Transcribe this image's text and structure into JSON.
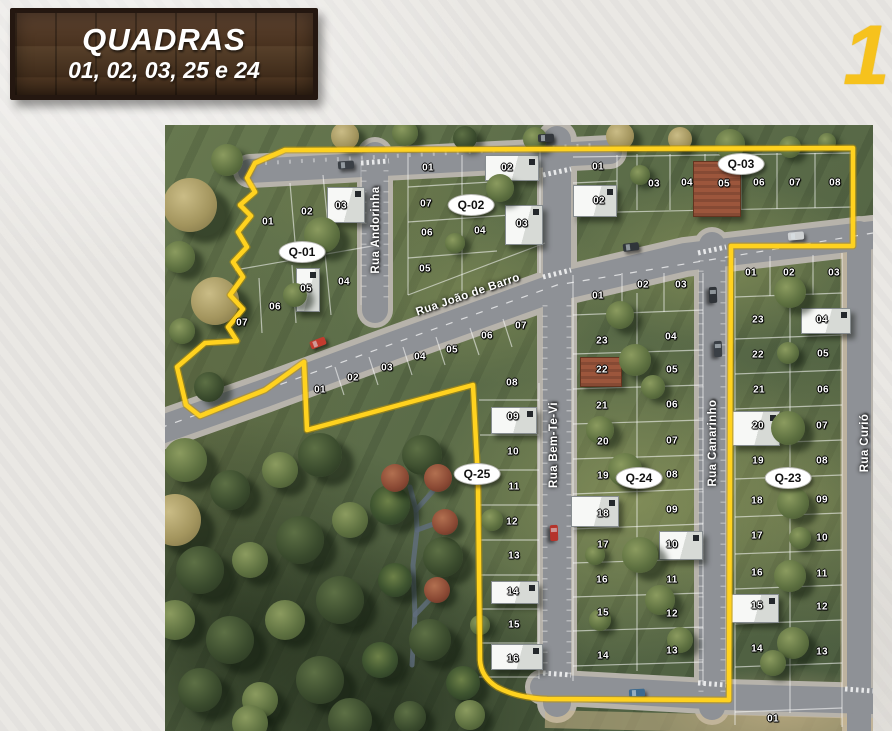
{
  "sign": {
    "title": "QUADRAS",
    "subtitle": "01, 02, 03, 25 e 24"
  },
  "corner_digit": "1",
  "colors": {
    "boundary_yellow": "#ffd21f",
    "sign_wood": "#4a3424",
    "badge_bg": "#ffffff",
    "corner_yellow": "#f6c21d"
  },
  "map": {
    "streets": [
      {
        "name": "Rua Andorinha",
        "x": 211,
        "y": 105,
        "rot": -90
      },
      {
        "name": "Rua João de Barro",
        "x": 303,
        "y": 170,
        "rot": -19
      },
      {
        "name": "Rua Bem-Te-Vi",
        "x": 389,
        "y": 320,
        "rot": -90
      },
      {
        "name": "Rua Canarinho",
        "x": 548,
        "y": 318,
        "rot": -90
      },
      {
        "name": "Rua Curió",
        "x": 700,
        "y": 318,
        "rot": -90
      }
    ],
    "quadra_badges": [
      {
        "id": "Q-01",
        "x": 137,
        "y": 127
      },
      {
        "id": "Q-02",
        "x": 306,
        "y": 80
      },
      {
        "id": "Q-03",
        "x": 576,
        "y": 39
      },
      {
        "id": "Q-25",
        "x": 312,
        "y": 349
      },
      {
        "id": "Q-24",
        "x": 474,
        "y": 353
      },
      {
        "id": "Q-23",
        "x": 623,
        "y": 353
      }
    ],
    "lots": [
      {
        "q": "Q-01",
        "n": "01",
        "x": 103,
        "y": 97
      },
      {
        "q": "Q-01",
        "n": "02",
        "x": 142,
        "y": 87
      },
      {
        "q": "Q-01",
        "n": "03",
        "x": 176,
        "y": 81
      },
      {
        "q": "Q-01",
        "n": "04",
        "x": 179,
        "y": 157
      },
      {
        "q": "Q-01",
        "n": "05",
        "x": 141,
        "y": 164
      },
      {
        "q": "Q-01",
        "n": "06",
        "x": 110,
        "y": 182
      },
      {
        "q": "Q-01",
        "n": "07",
        "x": 77,
        "y": 198
      },
      {
        "q": "Q-02",
        "n": "01",
        "x": 263,
        "y": 43
      },
      {
        "q": "Q-02",
        "n": "02",
        "x": 342,
        "y": 43
      },
      {
        "q": "Q-02",
        "n": "03",
        "x": 357,
        "y": 99
      },
      {
        "q": "Q-02",
        "n": "04",
        "x": 315,
        "y": 106
      },
      {
        "q": "Q-02",
        "n": "05",
        "x": 260,
        "y": 144
      },
      {
        "q": "Q-02",
        "n": "06",
        "x": 262,
        "y": 108
      },
      {
        "q": "Q-02",
        "n": "07",
        "x": 261,
        "y": 79
      },
      {
        "q": "Q-03",
        "n": "01",
        "x": 433,
        "y": 42
      },
      {
        "q": "Q-03",
        "n": "02",
        "x": 434,
        "y": 76
      },
      {
        "q": "Q-03",
        "n": "03",
        "x": 489,
        "y": 59
      },
      {
        "q": "Q-03",
        "n": "04",
        "x": 522,
        "y": 58
      },
      {
        "q": "Q-03",
        "n": "05",
        "x": 559,
        "y": 59
      },
      {
        "q": "Q-03",
        "n": "06",
        "x": 594,
        "y": 58
      },
      {
        "q": "Q-03",
        "n": "07",
        "x": 630,
        "y": 58
      },
      {
        "q": "Q-03",
        "n": "08",
        "x": 670,
        "y": 58
      },
      {
        "q": "Q-25",
        "n": "01",
        "x": 155,
        "y": 265
      },
      {
        "q": "Q-25",
        "n": "02",
        "x": 188,
        "y": 253
      },
      {
        "q": "Q-25",
        "n": "03",
        "x": 222,
        "y": 243
      },
      {
        "q": "Q-25",
        "n": "04",
        "x": 255,
        "y": 232
      },
      {
        "q": "Q-25",
        "n": "05",
        "x": 287,
        "y": 225
      },
      {
        "q": "Q-25",
        "n": "06",
        "x": 322,
        "y": 211
      },
      {
        "q": "Q-25",
        "n": "07",
        "x": 356,
        "y": 201
      },
      {
        "q": "Q-25",
        "n": "08",
        "x": 347,
        "y": 258
      },
      {
        "q": "Q-25",
        "n": "09",
        "x": 348,
        "y": 292
      },
      {
        "q": "Q-25",
        "n": "10",
        "x": 348,
        "y": 327
      },
      {
        "q": "Q-25",
        "n": "11",
        "x": 349,
        "y": 362
      },
      {
        "q": "Q-25",
        "n": "12",
        "x": 347,
        "y": 397
      },
      {
        "q": "Q-25",
        "n": "13",
        "x": 349,
        "y": 431
      },
      {
        "q": "Q-25",
        "n": "14",
        "x": 348,
        "y": 467
      },
      {
        "q": "Q-25",
        "n": "15",
        "x": 349,
        "y": 500
      },
      {
        "q": "Q-25",
        "n": "16",
        "x": 348,
        "y": 534
      },
      {
        "q": "Q-24",
        "n": "01",
        "x": 433,
        "y": 171
      },
      {
        "q": "Q-24",
        "n": "02",
        "x": 478,
        "y": 160
      },
      {
        "q": "Q-24",
        "n": "03",
        "x": 516,
        "y": 160
      },
      {
        "q": "Q-24",
        "n": "04",
        "x": 506,
        "y": 212
      },
      {
        "q": "Q-24",
        "n": "05",
        "x": 507,
        "y": 245
      },
      {
        "q": "Q-24",
        "n": "06",
        "x": 507,
        "y": 280
      },
      {
        "q": "Q-24",
        "n": "07",
        "x": 507,
        "y": 316
      },
      {
        "q": "Q-24",
        "n": "08",
        "x": 507,
        "y": 350
      },
      {
        "q": "Q-24",
        "n": "09",
        "x": 507,
        "y": 385
      },
      {
        "q": "Q-24",
        "n": "10",
        "x": 507,
        "y": 420
      },
      {
        "q": "Q-24",
        "n": "11",
        "x": 507,
        "y": 455
      },
      {
        "q": "Q-24",
        "n": "12",
        "x": 507,
        "y": 489
      },
      {
        "q": "Q-24",
        "n": "13",
        "x": 507,
        "y": 526
      },
      {
        "q": "Q-24",
        "n": "14",
        "x": 438,
        "y": 531
      },
      {
        "q": "Q-24",
        "n": "15",
        "x": 438,
        "y": 488
      },
      {
        "q": "Q-24",
        "n": "16",
        "x": 437,
        "y": 455
      },
      {
        "q": "Q-24",
        "n": "17",
        "x": 438,
        "y": 420
      },
      {
        "q": "Q-24",
        "n": "18",
        "x": 438,
        "y": 389
      },
      {
        "q": "Q-24",
        "n": "19",
        "x": 438,
        "y": 351
      },
      {
        "q": "Q-24",
        "n": "20",
        "x": 438,
        "y": 317
      },
      {
        "q": "Q-24",
        "n": "21",
        "x": 437,
        "y": 281
      },
      {
        "q": "Q-24",
        "n": "22",
        "x": 437,
        "y": 245
      },
      {
        "q": "Q-24",
        "n": "23",
        "x": 437,
        "y": 216
      },
      {
        "q": "Q-23",
        "n": "01",
        "x": 586,
        "y": 148
      },
      {
        "q": "Q-23",
        "n": "02",
        "x": 624,
        "y": 148
      },
      {
        "q": "Q-23",
        "n": "03",
        "x": 669,
        "y": 148
      },
      {
        "q": "Q-23",
        "n": "04",
        "x": 657,
        "y": 195
      },
      {
        "q": "Q-23",
        "n": "05",
        "x": 658,
        "y": 229
      },
      {
        "q": "Q-23",
        "n": "06",
        "x": 658,
        "y": 265
      },
      {
        "q": "Q-23",
        "n": "07",
        "x": 657,
        "y": 301
      },
      {
        "q": "Q-23",
        "n": "08",
        "x": 657,
        "y": 336
      },
      {
        "q": "Q-23",
        "n": "09",
        "x": 657,
        "y": 375
      },
      {
        "q": "Q-23",
        "n": "10",
        "x": 657,
        "y": 413
      },
      {
        "q": "Q-23",
        "n": "11",
        "x": 657,
        "y": 449
      },
      {
        "q": "Q-23",
        "n": "12",
        "x": 657,
        "y": 482
      },
      {
        "q": "Q-23",
        "n": "13",
        "x": 657,
        "y": 527
      },
      {
        "q": "Q-23",
        "n": "14",
        "x": 592,
        "y": 524
      },
      {
        "q": "Q-23",
        "n": "15",
        "x": 592,
        "y": 481
      },
      {
        "q": "Q-23",
        "n": "16",
        "x": 592,
        "y": 448
      },
      {
        "q": "Q-23",
        "n": "17",
        "x": 592,
        "y": 411
      },
      {
        "q": "Q-23",
        "n": "18",
        "x": 592,
        "y": 376
      },
      {
        "q": "Q-23",
        "n": "19",
        "x": 593,
        "y": 336
      },
      {
        "q": "Q-23",
        "n": "20",
        "x": 593,
        "y": 301
      },
      {
        "q": "Q-23",
        "n": "21",
        "x": 594,
        "y": 265
      },
      {
        "q": "Q-23",
        "n": "22",
        "x": 593,
        "y": 230
      },
      {
        "q": "Q-23",
        "n": "23",
        "x": 593,
        "y": 195
      },
      {
        "q": "",
        "n": "01",
        "x": 608,
        "y": 594
      }
    ],
    "houses": [
      {
        "x": 162,
        "y": 62,
        "w": 36,
        "h": 34,
        "type": "white"
      },
      {
        "x": 131,
        "y": 143,
        "w": 22,
        "h": 42,
        "type": "white"
      },
      {
        "x": 320,
        "y": 30,
        "w": 52,
        "h": 24,
        "type": "white"
      },
      {
        "x": 340,
        "y": 80,
        "w": 36,
        "h": 38,
        "type": "white"
      },
      {
        "x": 408,
        "y": 60,
        "w": 42,
        "h": 30,
        "type": "white"
      },
      {
        "x": 528,
        "y": 36,
        "w": 46,
        "h": 54,
        "type": "brick"
      },
      {
        "x": 326,
        "y": 282,
        "w": 44,
        "h": 25,
        "type": "white"
      },
      {
        "x": 326,
        "y": 456,
        "w": 46,
        "h": 21,
        "type": "white"
      },
      {
        "x": 326,
        "y": 519,
        "w": 50,
        "h": 24,
        "type": "white"
      },
      {
        "x": 406,
        "y": 371,
        "w": 46,
        "h": 29,
        "type": "white"
      },
      {
        "x": 494,
        "y": 406,
        "w": 42,
        "h": 27,
        "type": "white"
      },
      {
        "x": 415,
        "y": 232,
        "w": 40,
        "h": 28,
        "type": "brick"
      },
      {
        "x": 636,
        "y": 183,
        "w": 48,
        "h": 24,
        "type": "white"
      },
      {
        "x": 567,
        "y": 286,
        "w": 46,
        "h": 33,
        "type": "white"
      },
      {
        "x": 566,
        "y": 469,
        "w": 46,
        "h": 27,
        "type": "white"
      }
    ],
    "cars": [
      {
        "x": 173,
        "y": 36,
        "c": "#3a3f45",
        "a": -4
      },
      {
        "x": 373,
        "y": 9,
        "c": "#33373c",
        "a": -2
      },
      {
        "x": 458,
        "y": 118,
        "c": "#30353a",
        "a": -7
      },
      {
        "x": 623,
        "y": 107,
        "c": "#ced1d3",
        "a": -5
      },
      {
        "x": 145,
        "y": 214,
        "c": "#c23b2e",
        "a": -21
      },
      {
        "x": 381,
        "y": 404,
        "c": "#b5332a",
        "a": 88
      },
      {
        "x": 540,
        "y": 166,
        "c": "#2f3338",
        "a": 88
      },
      {
        "x": 545,
        "y": 220,
        "c": "#3a3f45",
        "a": 88
      },
      {
        "x": 464,
        "y": 564,
        "c": "#3d6a8f",
        "a": -3
      }
    ],
    "trees": [
      {
        "x": 25,
        "y": 80,
        "r": 27,
        "t": "olive"
      },
      {
        "x": 62,
        "y": 35,
        "r": 16,
        "t": "green"
      },
      {
        "x": 14,
        "y": 132,
        "r": 16,
        "t": "green"
      },
      {
        "x": 50,
        "y": 176,
        "r": 24,
        "t": "olive"
      },
      {
        "x": 17,
        "y": 206,
        "r": 13,
        "t": "green"
      },
      {
        "x": 44,
        "y": 262,
        "r": 15,
        "t": "dark"
      },
      {
        "x": 180,
        "y": 11,
        "r": 14,
        "t": "olive"
      },
      {
        "x": 240,
        "y": 8,
        "r": 13,
        "t": "green"
      },
      {
        "x": 300,
        "y": 13,
        "r": 12,
        "t": "dark"
      },
      {
        "x": 370,
        "y": 14,
        "r": 12,
        "t": "green"
      },
      {
        "x": 455,
        "y": 11,
        "r": 14,
        "t": "olive"
      },
      {
        "x": 515,
        "y": 14,
        "r": 12,
        "t": "olive"
      },
      {
        "x": 565,
        "y": 19,
        "r": 15,
        "t": "green"
      },
      {
        "x": 625,
        "y": 22,
        "r": 11,
        "t": "green"
      },
      {
        "x": 662,
        "y": 17,
        "r": 9,
        "t": "green"
      },
      {
        "x": 157,
        "y": 110,
        "r": 18,
        "t": "green"
      },
      {
        "x": 130,
        "y": 170,
        "r": 12,
        "t": "green"
      },
      {
        "x": 335,
        "y": 63,
        "r": 14,
        "t": "green"
      },
      {
        "x": 290,
        "y": 118,
        "r": 10,
        "t": "green"
      },
      {
        "x": 475,
        "y": 50,
        "r": 10,
        "t": "green"
      },
      {
        "x": 20,
        "y": 335,
        "r": 22,
        "t": "green"
      },
      {
        "x": 10,
        "y": 395,
        "r": 26,
        "t": "olive"
      },
      {
        "x": 65,
        "y": 365,
        "r": 20,
        "t": "dark"
      },
      {
        "x": 115,
        "y": 345,
        "r": 18,
        "t": "green"
      },
      {
        "x": 155,
        "y": 330,
        "r": 22,
        "t": "dark"
      },
      {
        "x": 35,
        "y": 445,
        "r": 24,
        "t": "dark"
      },
      {
        "x": 85,
        "y": 435,
        "r": 18,
        "t": "green"
      },
      {
        "x": 135,
        "y": 415,
        "r": 24,
        "t": "dark"
      },
      {
        "x": 185,
        "y": 395,
        "r": 18,
        "t": "green"
      },
      {
        "x": 225,
        "y": 380,
        "r": 20,
        "t": "palm"
      },
      {
        "x": 257,
        "y": 330,
        "r": 20,
        "t": "dark"
      },
      {
        "x": 10,
        "y": 495,
        "r": 20,
        "t": "green"
      },
      {
        "x": 65,
        "y": 515,
        "r": 24,
        "t": "dark"
      },
      {
        "x": 120,
        "y": 495,
        "r": 20,
        "t": "green"
      },
      {
        "x": 175,
        "y": 475,
        "r": 24,
        "t": "dark"
      },
      {
        "x": 230,
        "y": 455,
        "r": 17,
        "t": "palm"
      },
      {
        "x": 278,
        "y": 432,
        "r": 20,
        "t": "dark"
      },
      {
        "x": 35,
        "y": 565,
        "r": 22,
        "t": "dark"
      },
      {
        "x": 95,
        "y": 575,
        "r": 18,
        "t": "green"
      },
      {
        "x": 155,
        "y": 555,
        "r": 24,
        "t": "dark"
      },
      {
        "x": 215,
        "y": 535,
        "r": 18,
        "t": "palm"
      },
      {
        "x": 265,
        "y": 515,
        "r": 21,
        "t": "dark"
      },
      {
        "x": 298,
        "y": 558,
        "r": 17,
        "t": "palm"
      },
      {
        "x": 185,
        "y": 595,
        "r": 22,
        "t": "dark"
      },
      {
        "x": 85,
        "y": 598,
        "r": 18,
        "t": "green"
      },
      {
        "x": 245,
        "y": 592,
        "r": 16,
        "t": "dark"
      },
      {
        "x": 305,
        "y": 590,
        "r": 15,
        "t": "green"
      },
      {
        "x": 230,
        "y": 353,
        "r": 14,
        "t": "red"
      },
      {
        "x": 273,
        "y": 353,
        "r": 14,
        "t": "red"
      },
      {
        "x": 280,
        "y": 397,
        "r": 13,
        "t": "red"
      },
      {
        "x": 272,
        "y": 465,
        "r": 13,
        "t": "red"
      },
      {
        "x": 470,
        "y": 235,
        "r": 16,
        "t": "green"
      },
      {
        "x": 455,
        "y": 190,
        "r": 14,
        "t": "green"
      },
      {
        "x": 488,
        "y": 262,
        "r": 12,
        "t": "green"
      },
      {
        "x": 435,
        "y": 305,
        "r": 14,
        "t": "green"
      },
      {
        "x": 460,
        "y": 345,
        "r": 17,
        "t": "green"
      },
      {
        "x": 430,
        "y": 430,
        "r": 10,
        "t": "green"
      },
      {
        "x": 475,
        "y": 430,
        "r": 18,
        "t": "green"
      },
      {
        "x": 495,
        "y": 475,
        "r": 15,
        "t": "green"
      },
      {
        "x": 435,
        "y": 495,
        "r": 11,
        "t": "green"
      },
      {
        "x": 515,
        "y": 515,
        "r": 13,
        "t": "green"
      },
      {
        "x": 327,
        "y": 395,
        "r": 11,
        "t": "green"
      },
      {
        "x": 315,
        "y": 500,
        "r": 10,
        "t": "green"
      },
      {
        "x": 625,
        "y": 167,
        "r": 16,
        "t": "green"
      },
      {
        "x": 623,
        "y": 228,
        "r": 11,
        "t": "green"
      },
      {
        "x": 623,
        "y": 303,
        "r": 17,
        "t": "green"
      },
      {
        "x": 628,
        "y": 378,
        "r": 16,
        "t": "green"
      },
      {
        "x": 635,
        "y": 413,
        "r": 11,
        "t": "green"
      },
      {
        "x": 625,
        "y": 451,
        "r": 16,
        "t": "green"
      },
      {
        "x": 628,
        "y": 518,
        "r": 16,
        "t": "green"
      },
      {
        "x": 608,
        "y": 538,
        "r": 13,
        "t": "green"
      }
    ]
  }
}
